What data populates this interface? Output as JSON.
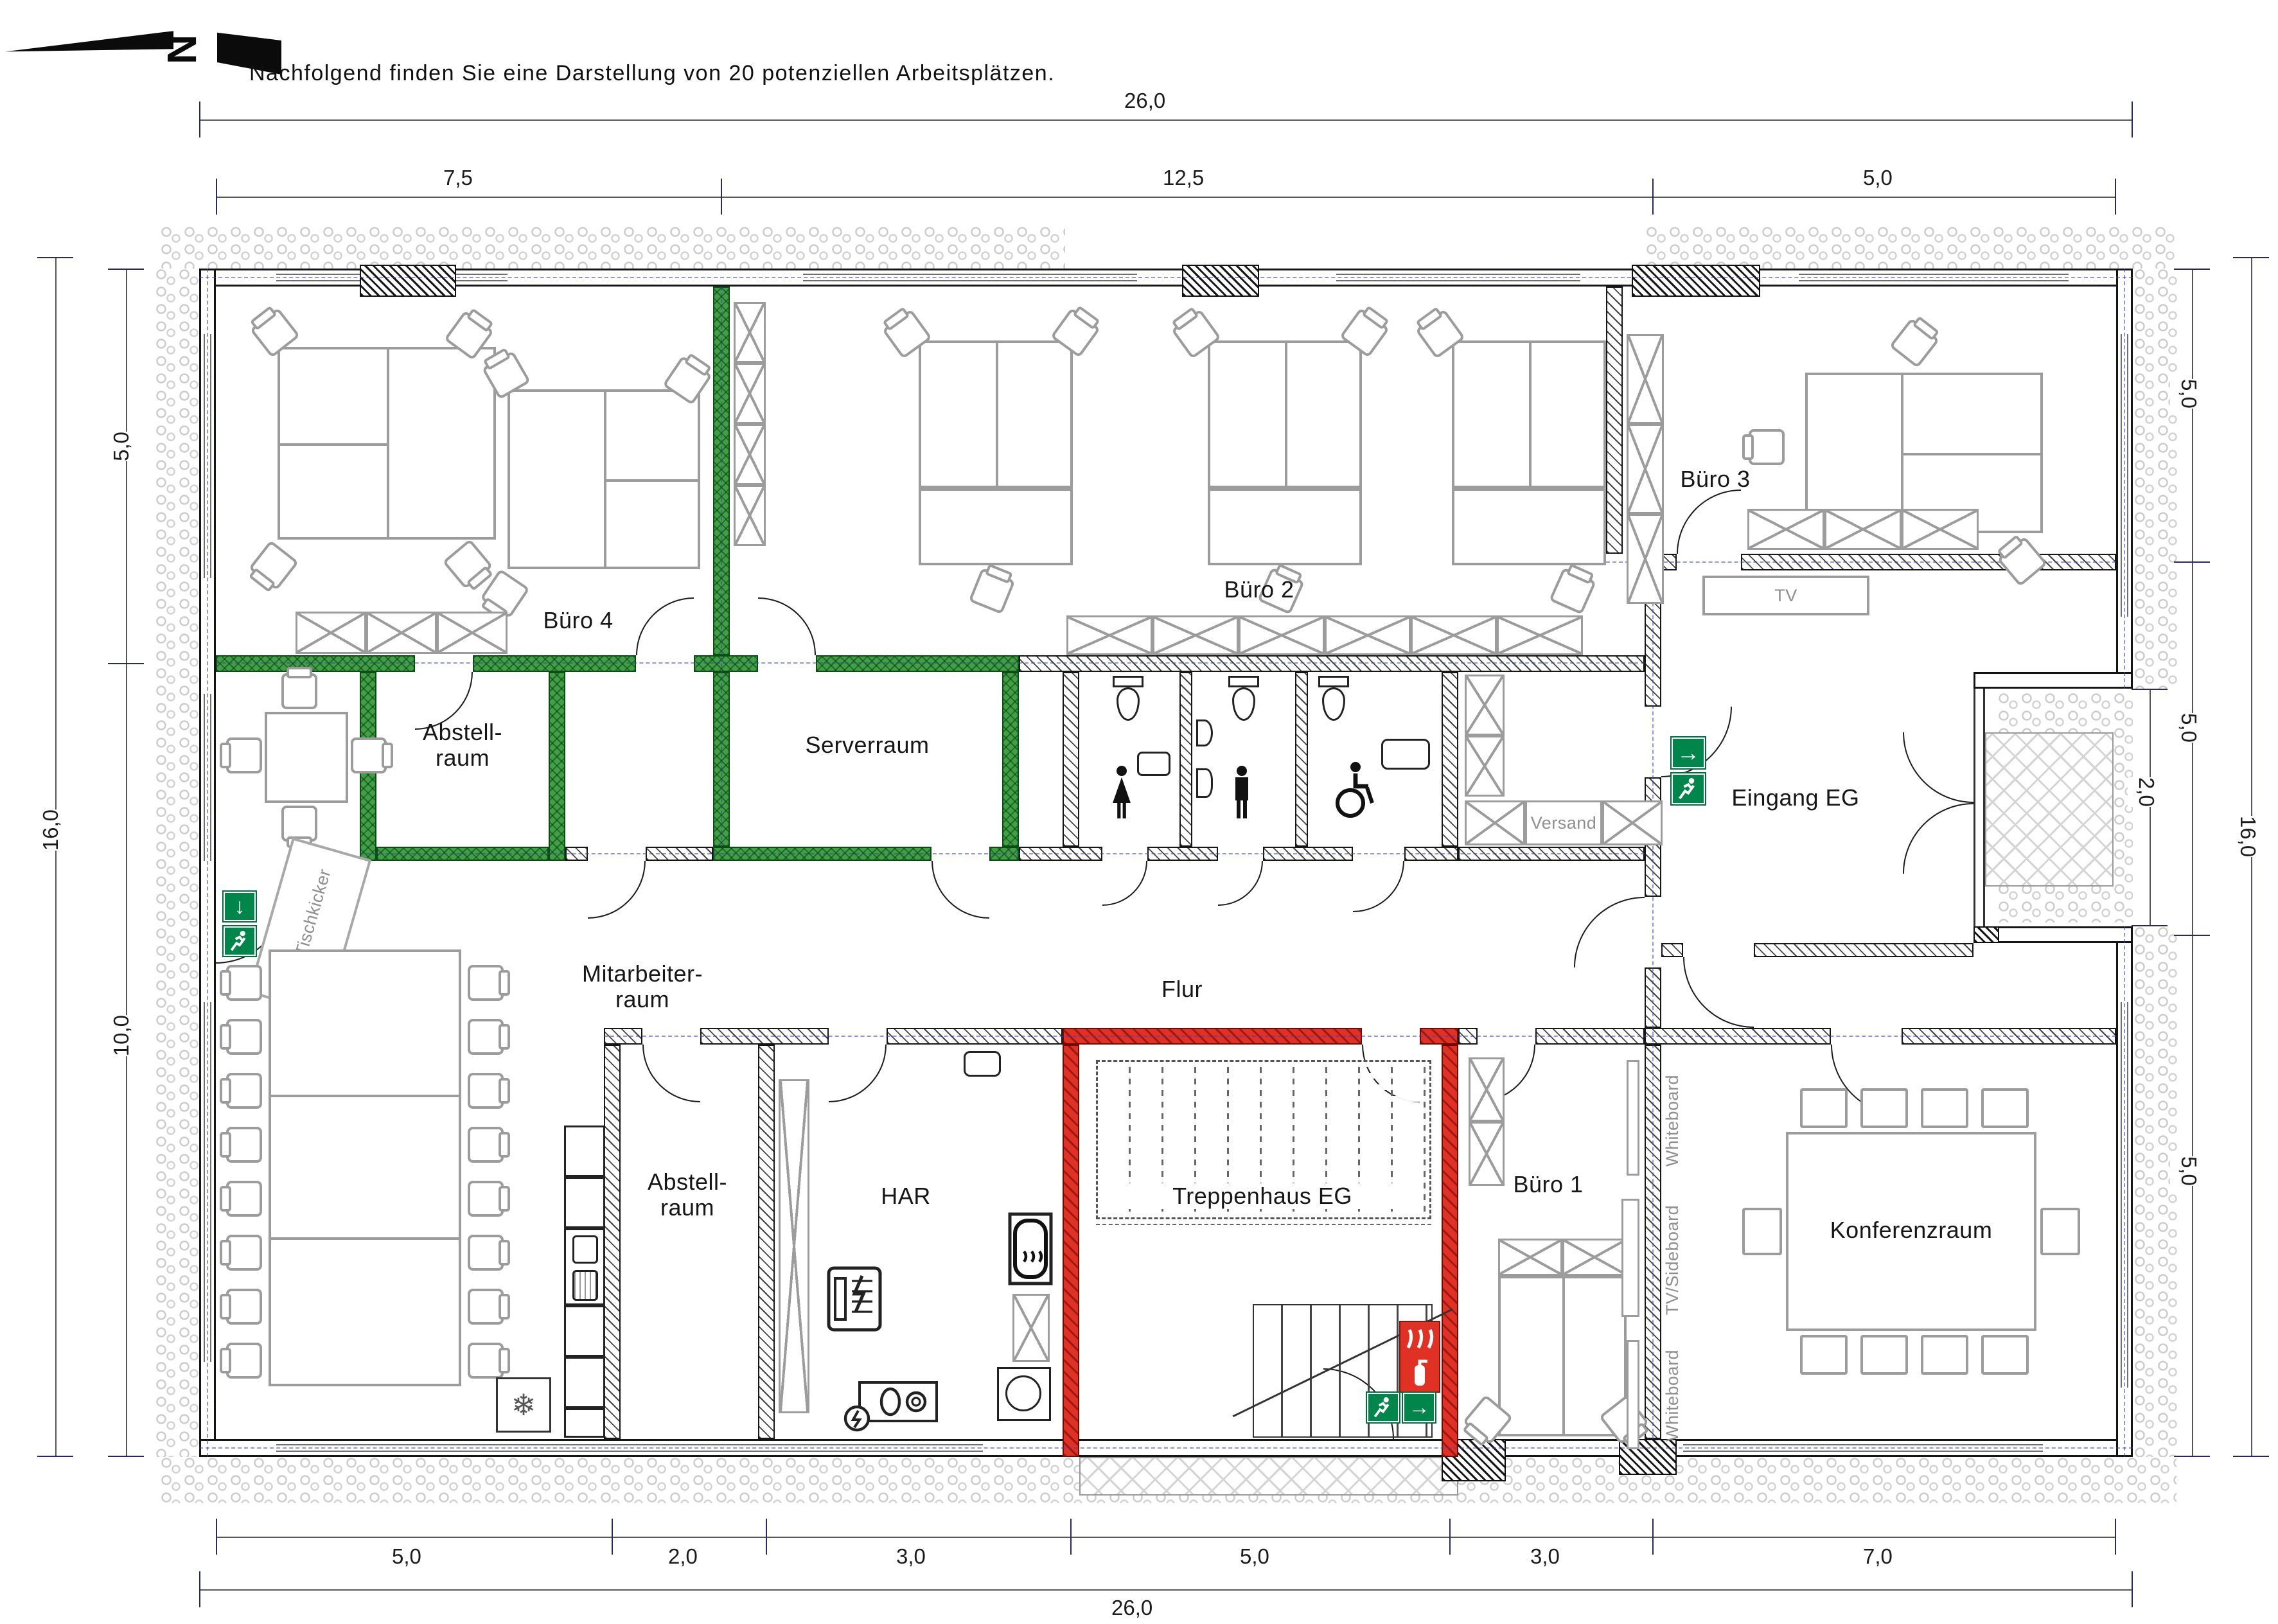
{
  "title": "Nachfolgend finden Sie eine Darstellung von 20 potenziellen Arbeitsplätzen.",
  "north": {
    "label": "N"
  },
  "dimensions": {
    "top_total": "26,0",
    "top_segments": [
      "7,5",
      "12,5",
      "5,0"
    ],
    "bottom_segments": [
      "5,0",
      "2,0",
      "3,0",
      "5,0",
      "3,0",
      "7,0"
    ],
    "bottom_total": "26,0",
    "left_outer": "16,0",
    "left_segments": [
      "5,0",
      "10,0"
    ],
    "right_outer": "16,0",
    "right_segments": [
      "5,0",
      "5,0",
      "2,0",
      "5,0"
    ]
  },
  "rooms": {
    "buero4": "Büro 4",
    "buero2": "Büro 2",
    "buero3": "Büro 3",
    "abstell_top_1": "Abstell-",
    "abstell_top_2": "raum",
    "serverraum": "Serverraum",
    "eingang": "Eingang EG",
    "flur": "Flur",
    "mitarbeiter_1": "Mitarbeiter-",
    "mitarbeiter_2": "raum",
    "abstell_bottom_1": "Abstell-",
    "abstell_bottom_2": "raum",
    "har": "HAR",
    "treppenhaus": "Treppenhaus EG",
    "buero1": "Büro 1",
    "konferenzraum": "Konferenzraum"
  },
  "furniture_labels": {
    "versand": "Versand",
    "tv": "TV",
    "tischkicker": "Tischkicker",
    "whiteboard_top": "Whiteboard",
    "tv_sideboard": "TV/Sideboard",
    "whiteboard_bottom": "Whiteboard"
  },
  "colors": {
    "green_wall": "#3FA046",
    "red_wall": "#E03125",
    "exit_sign_green": "#00854A",
    "furniture_gray": "#9C9C9C",
    "axis_blue": "#4444BB"
  }
}
